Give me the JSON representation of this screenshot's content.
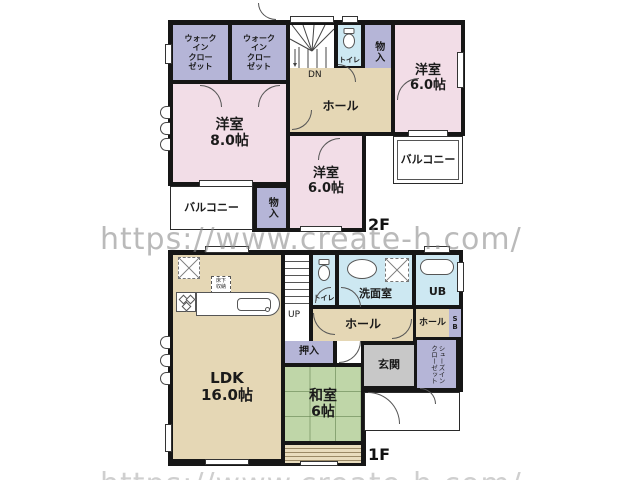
{
  "watermark": "https://www.create-h.com/",
  "colors": {
    "pink": "#f2dde7",
    "lavender": "#b5b5d7",
    "beige": "#e5d7b5",
    "blue": "#cde8f2",
    "green": "#bfd6a8",
    "gray": "#c8c8c8",
    "wall": "#161616",
    "watermark": "#8a8a8a"
  },
  "f2": {
    "floor_label": "2F",
    "rooms": {
      "wic1": "ウォーク\nイン\nクロー\nゼット",
      "wic2": "ウォーク\nイン\nクロー\nゼット",
      "dn": "DN",
      "toilet": "トイレ",
      "mono_top": "物入",
      "yo6ne": "洋室\n6.0帖",
      "hall": "ホール",
      "yo8": "洋室\n8.0帖",
      "yo6s": "洋室\n6.0帖",
      "mono_s": "物入",
      "balcony_e": "バルコニー",
      "balcony_sw": "バルコニー"
    }
  },
  "f1": {
    "floor_label": "1F",
    "rooms": {
      "ldk": "LDK\n16.0帖",
      "yukashita": "床下\n収納",
      "up": "UP",
      "toilet": "トイレ",
      "senmen": "洗面室",
      "ub": "UB",
      "hall": "ホール",
      "hall_e": "ホール",
      "sb": "S\nB",
      "oshiire": "押入",
      "washitsu": "和室\n6帖",
      "genkan": "玄関",
      "shoes": "シューズイン\nクローゼット"
    }
  }
}
